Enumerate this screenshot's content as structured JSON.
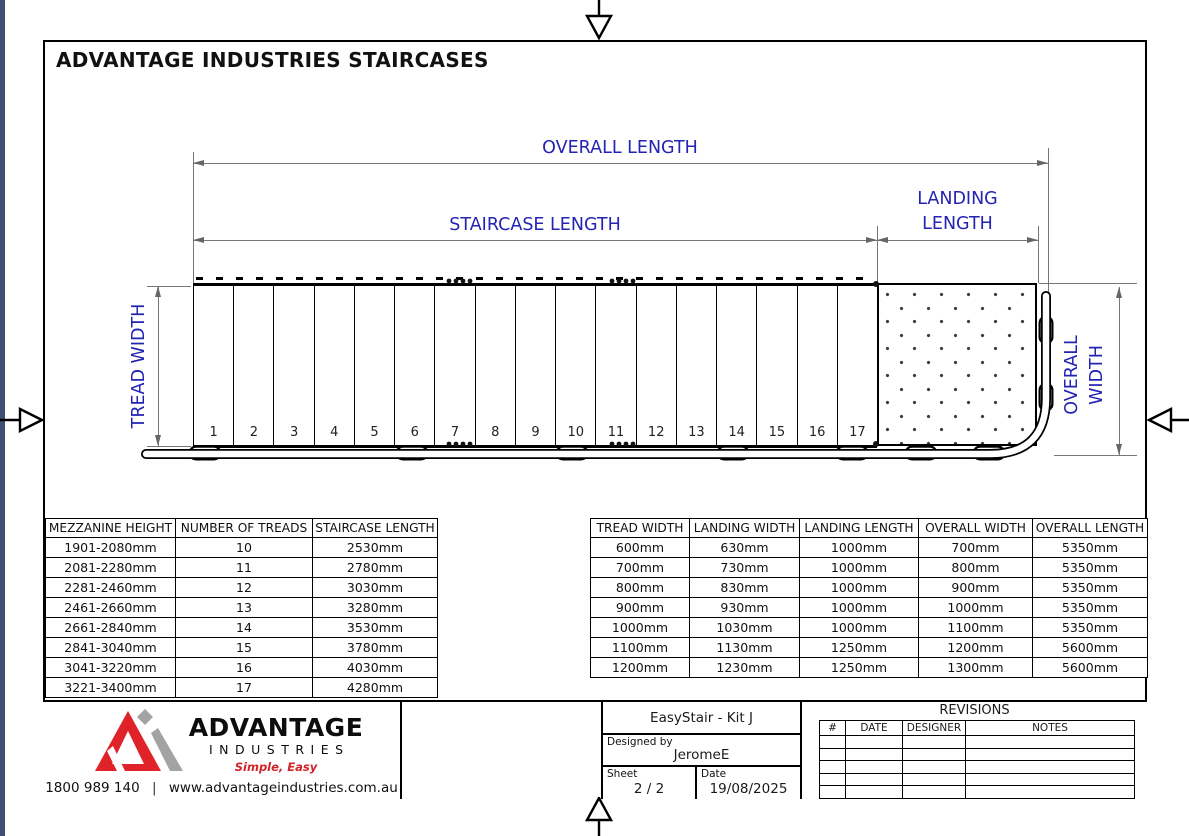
{
  "sheet": {
    "title": "ADVANTAGE INDUSTRIES STAIRCASES"
  },
  "drawing": {
    "dim_labels": {
      "overall_length": "OVERALL LENGTH",
      "staircase_length": "STAIRCASE LENGTH",
      "landing_length_line1": "LANDING",
      "landing_length_line2": "LENGTH",
      "tread_width": "TREAD WIDTH",
      "landing_width_line1": "LANDING",
      "landing_width_line2": "WIDTH",
      "overall_width_line1": "OVERALL",
      "overall_width_line2": "WIDTH"
    },
    "tread_numbers": [
      "1",
      "2",
      "3",
      "4",
      "5",
      "6",
      "7",
      "8",
      "9",
      "10",
      "11",
      "12",
      "13",
      "14",
      "15",
      "16",
      "17"
    ]
  },
  "tables": {
    "staircase_selection": {
      "headers": [
        "MEZZANINE HEIGHT",
        "NUMBER OF TREADS",
        "STAIRCASE LENGTH"
      ],
      "rows": [
        [
          "1901-2080mm",
          "10",
          "2530mm"
        ],
        [
          "2081-2280mm",
          "11",
          "2780mm"
        ],
        [
          "2281-2460mm",
          "12",
          "3030mm"
        ],
        [
          "2461-2660mm",
          "13",
          "3280mm"
        ],
        [
          "2661-2840mm",
          "14",
          "3530mm"
        ],
        [
          "2841-3040mm",
          "15",
          "3780mm"
        ],
        [
          "3041-3220mm",
          "16",
          "4030mm"
        ],
        [
          "3221-3400mm",
          "17",
          "4280mm"
        ]
      ]
    },
    "width_options": {
      "headers": [
        "TREAD WIDTH",
        "LANDING WIDTH",
        "LANDING LENGTH",
        "OVERALL WIDTH",
        "OVERALL LENGTH"
      ],
      "rows": [
        [
          "600mm",
          "630mm",
          "1000mm",
          "700mm",
          "5350mm"
        ],
        [
          "700mm",
          "730mm",
          "1000mm",
          "800mm",
          "5350mm"
        ],
        [
          "800mm",
          "830mm",
          "1000mm",
          "900mm",
          "5350mm"
        ],
        [
          "900mm",
          "930mm",
          "1000mm",
          "1000mm",
          "5350mm"
        ],
        [
          "1000mm",
          "1030mm",
          "1000mm",
          "1100mm",
          "5350mm"
        ],
        [
          "1100mm",
          "1130mm",
          "1250mm",
          "1200mm",
          "5600mm"
        ],
        [
          "1200mm",
          "1230mm",
          "1250mm",
          "1300mm",
          "5600mm"
        ]
      ]
    }
  },
  "title_block": {
    "project": "EasyStair - Kit J",
    "designed_by_label": "Designed by",
    "designer": "JeromeE",
    "sheet_label": "Sheet",
    "sheet_value": "2 / 2",
    "date_label": "Date",
    "date_value": "19/08/2025",
    "revisions": {
      "title": "REVISIONS",
      "columns": [
        "#",
        "DATE",
        "DESIGNER",
        "NOTES"
      ],
      "empty_row_count": 5
    }
  },
  "logo": {
    "brand": "ADVANTAGE",
    "sub": "INDUSTRIES",
    "tagline": "Simple, Easy",
    "phone": "1800 989 140",
    "separator": "|",
    "website": "www.advantageindustries.com.au"
  },
  "colors": {
    "dim_label_blue": "#2323b4",
    "dim_line_gray": "#777777",
    "drawing_black": "#000000",
    "logo_red": "#e02329",
    "logo_gray": "#a3a3a3",
    "tagline_red": "#d22328",
    "edge_strip": "#414e74"
  }
}
